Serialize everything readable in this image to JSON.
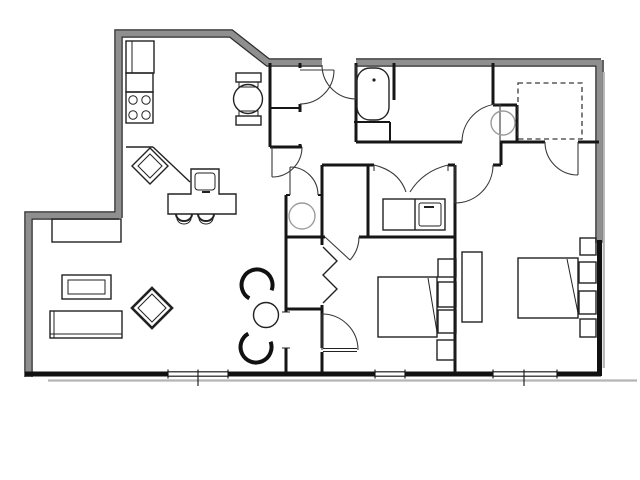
{
  "plan": {
    "type": "apartment-floor-plan",
    "rooms": {
      "kitchen": {
        "name": "KITCHEN",
        "dims": "12'-11\" x 12'-2\""
      },
      "living_room": {
        "name": "LIVING ROOM",
        "dims": "14'-8\" x 21'-5\""
      },
      "bathroom": {
        "name": "BATHROOM"
      },
      "walk_in_closet": {
        "line1": "WALK-IN",
        "line2": "CLOSET"
      },
      "master_bedroom": {
        "name": "MASTER BEDROOM",
        "dims": "19'-1\" x 11'-6\""
      },
      "bedroom": {
        "name": "BEDROOM",
        "dims": "11'-7\" x 11'-5\""
      }
    },
    "colors": {
      "background": "#ffffff",
      "wall_exterior_gray": "#8f8f8f",
      "wall_interior": "#161616",
      "text": "#3c3c3c",
      "fixture_gray": "#9c9c9c"
    }
  }
}
